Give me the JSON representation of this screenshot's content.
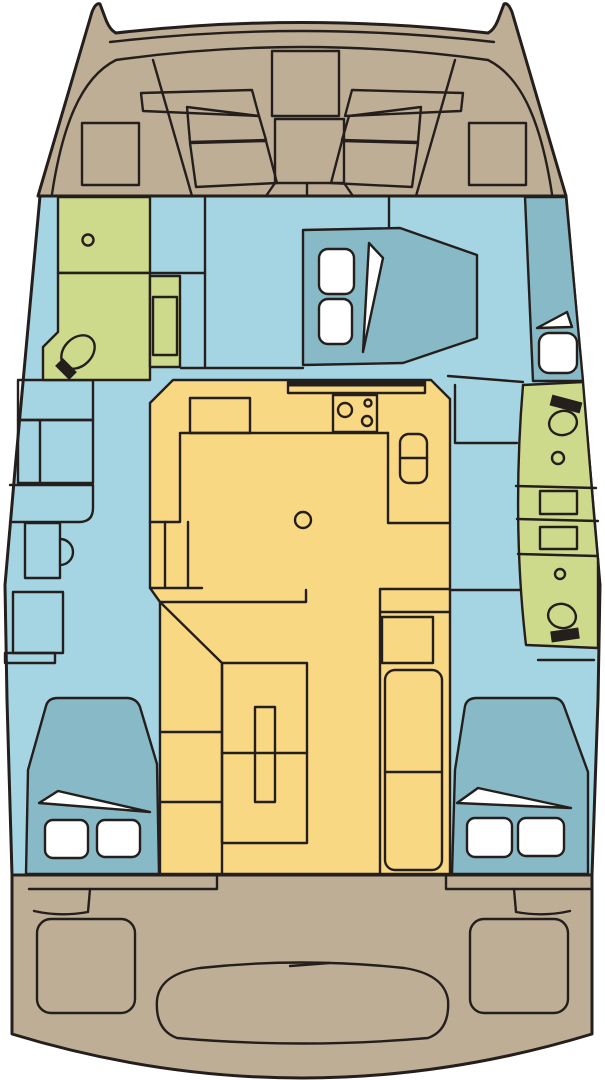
{
  "colors": {
    "outline": "#241f1c",
    "background": "#ffffff",
    "deck": "#bfae96",
    "floor": "#a5d5e3",
    "wetroom": "#cdda8c",
    "furniture": "#f9d883",
    "berth": "#87b9c7",
    "white": "#ffffff"
  }
}
